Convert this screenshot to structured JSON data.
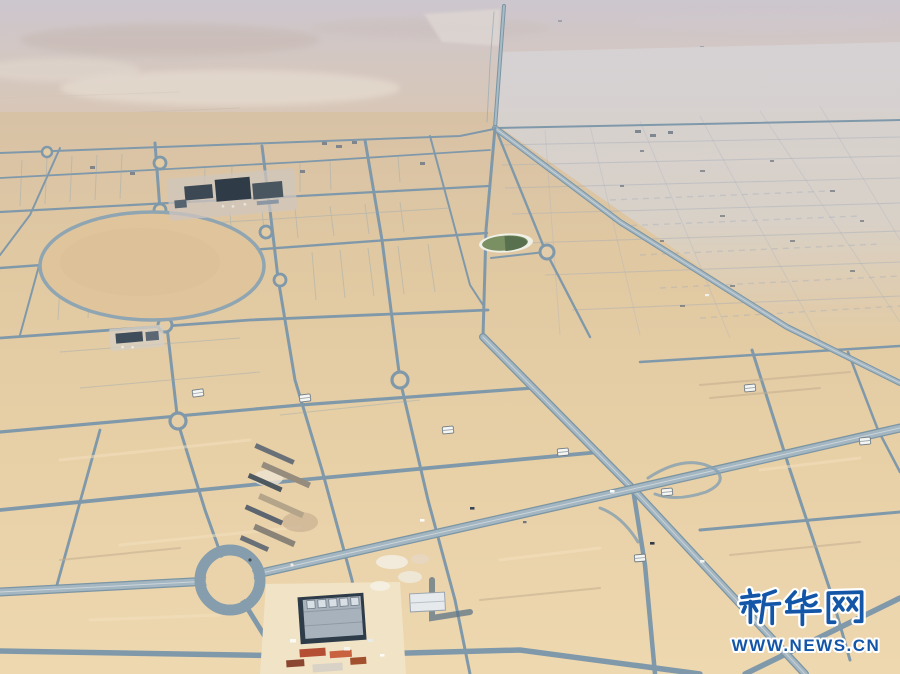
{
  "image": {
    "kind": "aerial-photograph",
    "subject": "Planned desert city street grid under construction seen from the air"
  },
  "watermark": {
    "brand": "新华网",
    "brand_romanized": "Xinhua Net",
    "url": "WWW.NEWS.CN",
    "brand_color": "#1356a8",
    "outline_color": "#ffffff"
  },
  "palette": {
    "haze_top": "#ccc5cd",
    "distant_desert": "#d8c6b8",
    "pale_flat_area": "#d6d2d3",
    "sand": "#e6cda4",
    "sand_bright": "#eed7af",
    "road": "#8099aa",
    "road_light": "#a6b8c2",
    "pond_green": "#76895e",
    "dark_roofs": "#35424e"
  },
  "scene": {
    "landmarks": [
      "divided highway from horizon",
      "rectangular street grid with roundabouts",
      "large circular empty plot",
      "green water reservoir",
      "dark building cluster",
      "construction staging rows",
      "industrial building site",
      "large roundabout near bottom"
    ]
  }
}
